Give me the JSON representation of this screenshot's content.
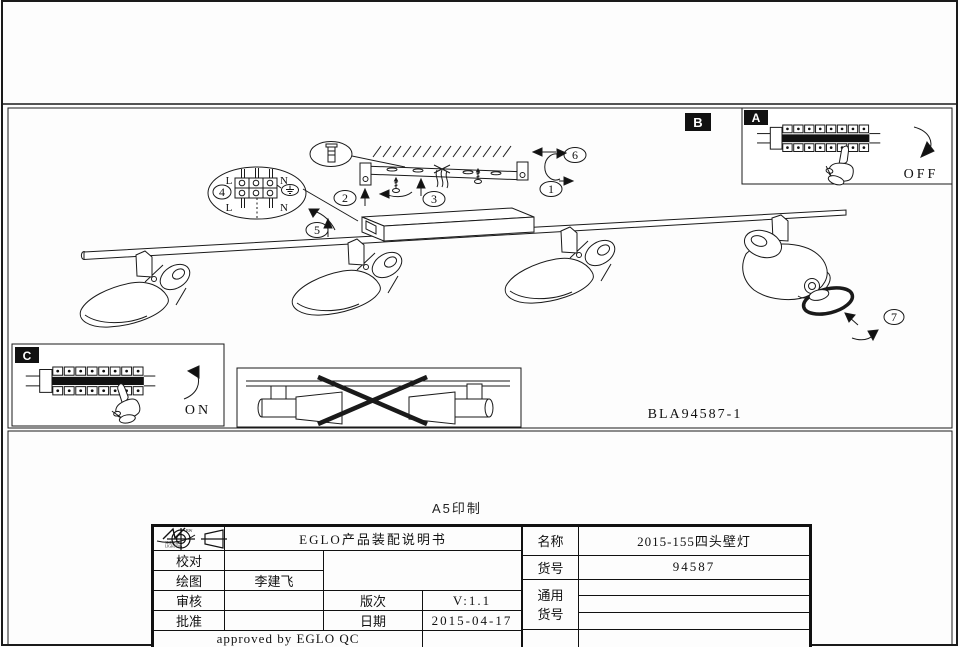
{
  "page": {
    "print_note": "A5印制"
  },
  "diagram": {
    "code": "BLA94587-1",
    "label_a": "A",
    "label_b": "B",
    "label_c": "C",
    "off_text": "OFF",
    "on_text": "ON",
    "callout_1": "1",
    "callout_2": "2",
    "callout_3": "3",
    "callout_4": "4",
    "callout_5": "5",
    "callout_6": "6",
    "callout_7": "7",
    "wiring": {
      "l_top": "L",
      "n_top": "N",
      "l_bot": "L",
      "n_bot": "N"
    }
  },
  "title_block": {
    "logo": {
      "line1": "SHENGDA",
      "line2": "LIGHTING",
      "mark": "BW"
    },
    "doc_title": "EGLO产品装配说明书",
    "check_label": "校对",
    "check_value": "",
    "draw_label": "绘图",
    "draw_value": "李建飞",
    "review_label": "审核",
    "review_value": "",
    "approve_label": "批准",
    "approve_value": "",
    "version_label": "版次",
    "version_value": "V:1.1",
    "date_label": "日期",
    "date_value": "2015-04-17",
    "approved_line": "approved by EGLO QC",
    "name_label": "名称",
    "name_value": "2015-155四头壁灯",
    "item_label": "货号",
    "item_value": "94587",
    "common_label_line1": "通用",
    "common_label_line2": "货号"
  }
}
